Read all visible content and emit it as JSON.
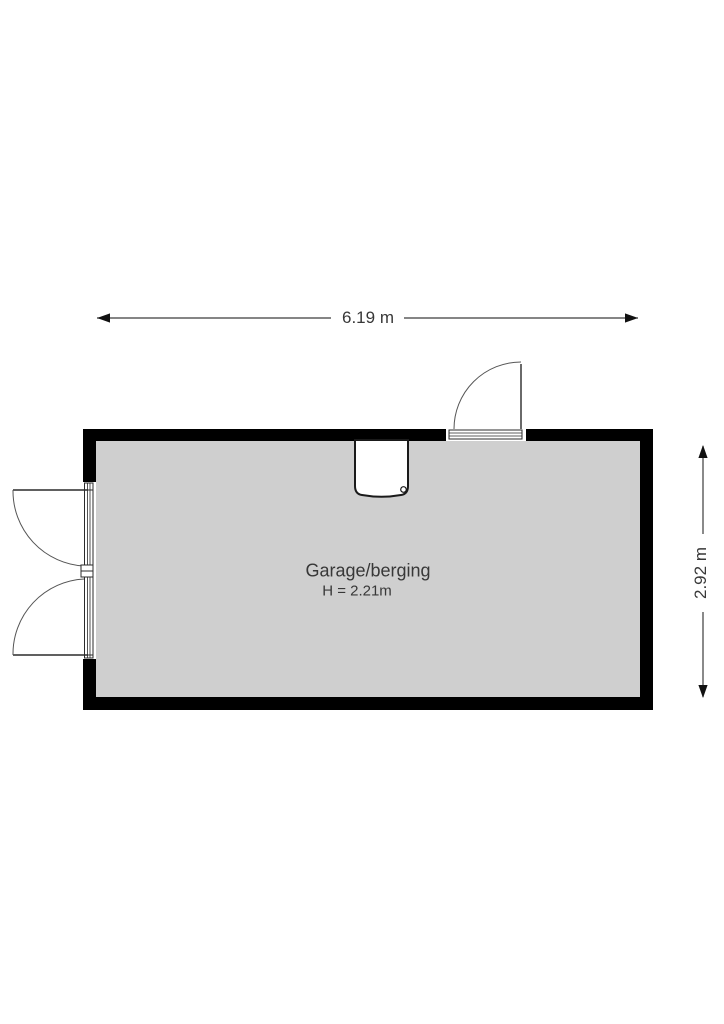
{
  "floorplan": {
    "room": {
      "name": "Garage/berging",
      "ceiling_height": "H = 2.21m"
    },
    "dimensions": {
      "width": "6.19 m",
      "height": "2.92 m"
    },
    "doors": {
      "top_right": "single-swing-door",
      "left": "double-swing-door"
    },
    "fixtures": {
      "top_center": "sink-basin"
    },
    "colors": {
      "wall": "#000000",
      "floor": "#cfcfcf",
      "line": "#3c3c3c",
      "text": "#383838",
      "background": "#ffffff"
    }
  }
}
